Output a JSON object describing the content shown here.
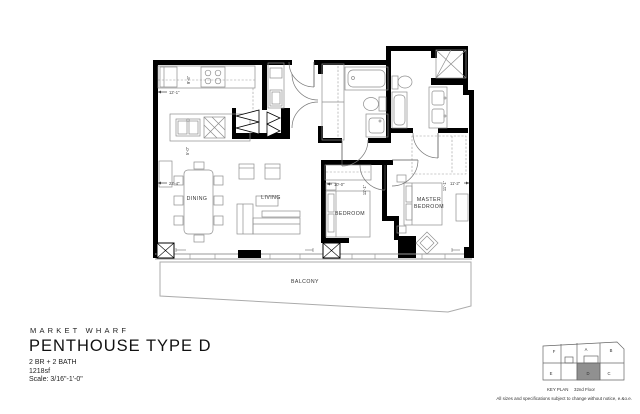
{
  "title_block": {
    "project": "MARKET WHARF",
    "plan_name": "PENTHOUSE TYPE D",
    "configuration": "2 BR + 2 BATH",
    "area": "1218sf",
    "scale": "Scale:  3/16\"-1'-0\""
  },
  "plan": {
    "rooms": {
      "dining": "DINING",
      "living": "LIVING",
      "bedroom": "BEDROOM",
      "master_line1": "MASTER",
      "master_line2": "BEDROOM",
      "balcony": "BALCONY"
    },
    "dimensions": {
      "kitchen_width": "12'-1\"",
      "kitchen_depth": "9'-6\"",
      "island_length": "5'-0\"",
      "living_width": "22'-4\"",
      "bedroom_width": "10'-0\"",
      "bedroom_depth": "11'-1\"",
      "master_depth": "11'-1\"",
      "master_width": "11'-2\""
    }
  },
  "key_plan": {
    "label": "KEY PLAN",
    "floor": "32nd Floor",
    "units": {
      "f": "F",
      "a": "A",
      "b": "B",
      "e": "E",
      "d": "D",
      "c": "C"
    },
    "highlighted_unit": "D",
    "highlight_color": "#909090"
  },
  "disclaimer": "All sizes and specifications subject to change without notice, e.&o.e."
}
